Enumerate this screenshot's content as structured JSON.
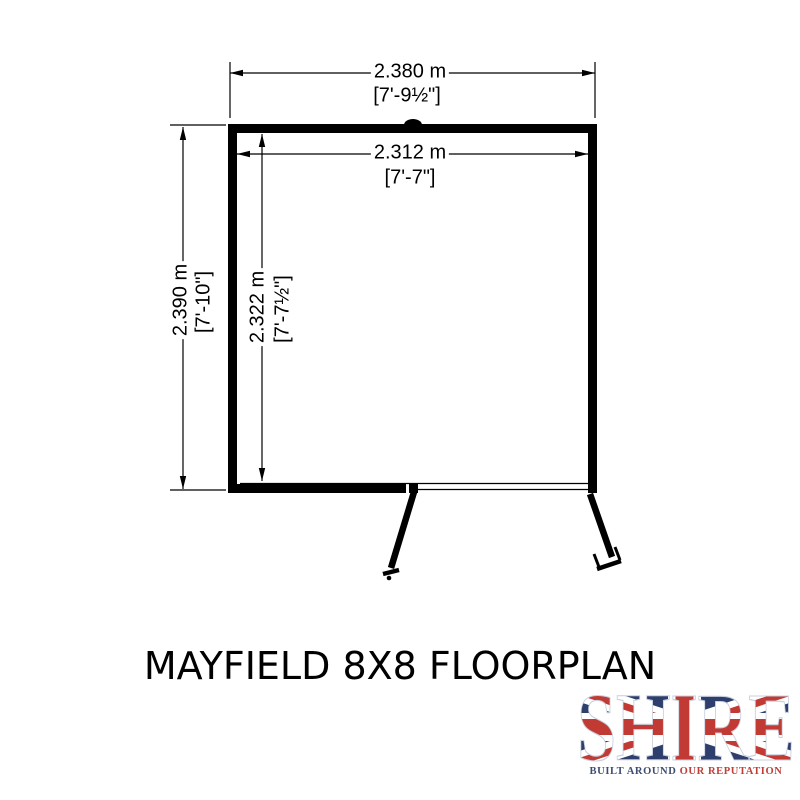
{
  "title": "MAYFIELD 8X8 FLOORPLAN",
  "floorplan": {
    "dimensions": {
      "outer_width": {
        "metric": "2.380 m",
        "imperial": "[7'-9½\"]"
      },
      "inner_width": {
        "metric": "2.312 m",
        "imperial": "[7'-7\"]"
      },
      "outer_height": {
        "metric": "2.390 m",
        "imperial": "[7'-10\"]"
      },
      "inner_height": {
        "metric": "2.322 m",
        "imperial": "[7'-7½\"]"
      }
    },
    "drawing_color": "#000000",
    "background": "#ffffff"
  },
  "logo": {
    "brand": "SHIRE",
    "tagline_left": "BUILT AROUND",
    "tagline_right": "OUR REPUTATION",
    "colors": {
      "flag_blue": "#2e3f6d",
      "flag_red": "#c13a34",
      "flag_white": "#ffffff",
      "tagline_navy": "#3d4c71",
      "tagline_red": "#bf3f38"
    }
  }
}
